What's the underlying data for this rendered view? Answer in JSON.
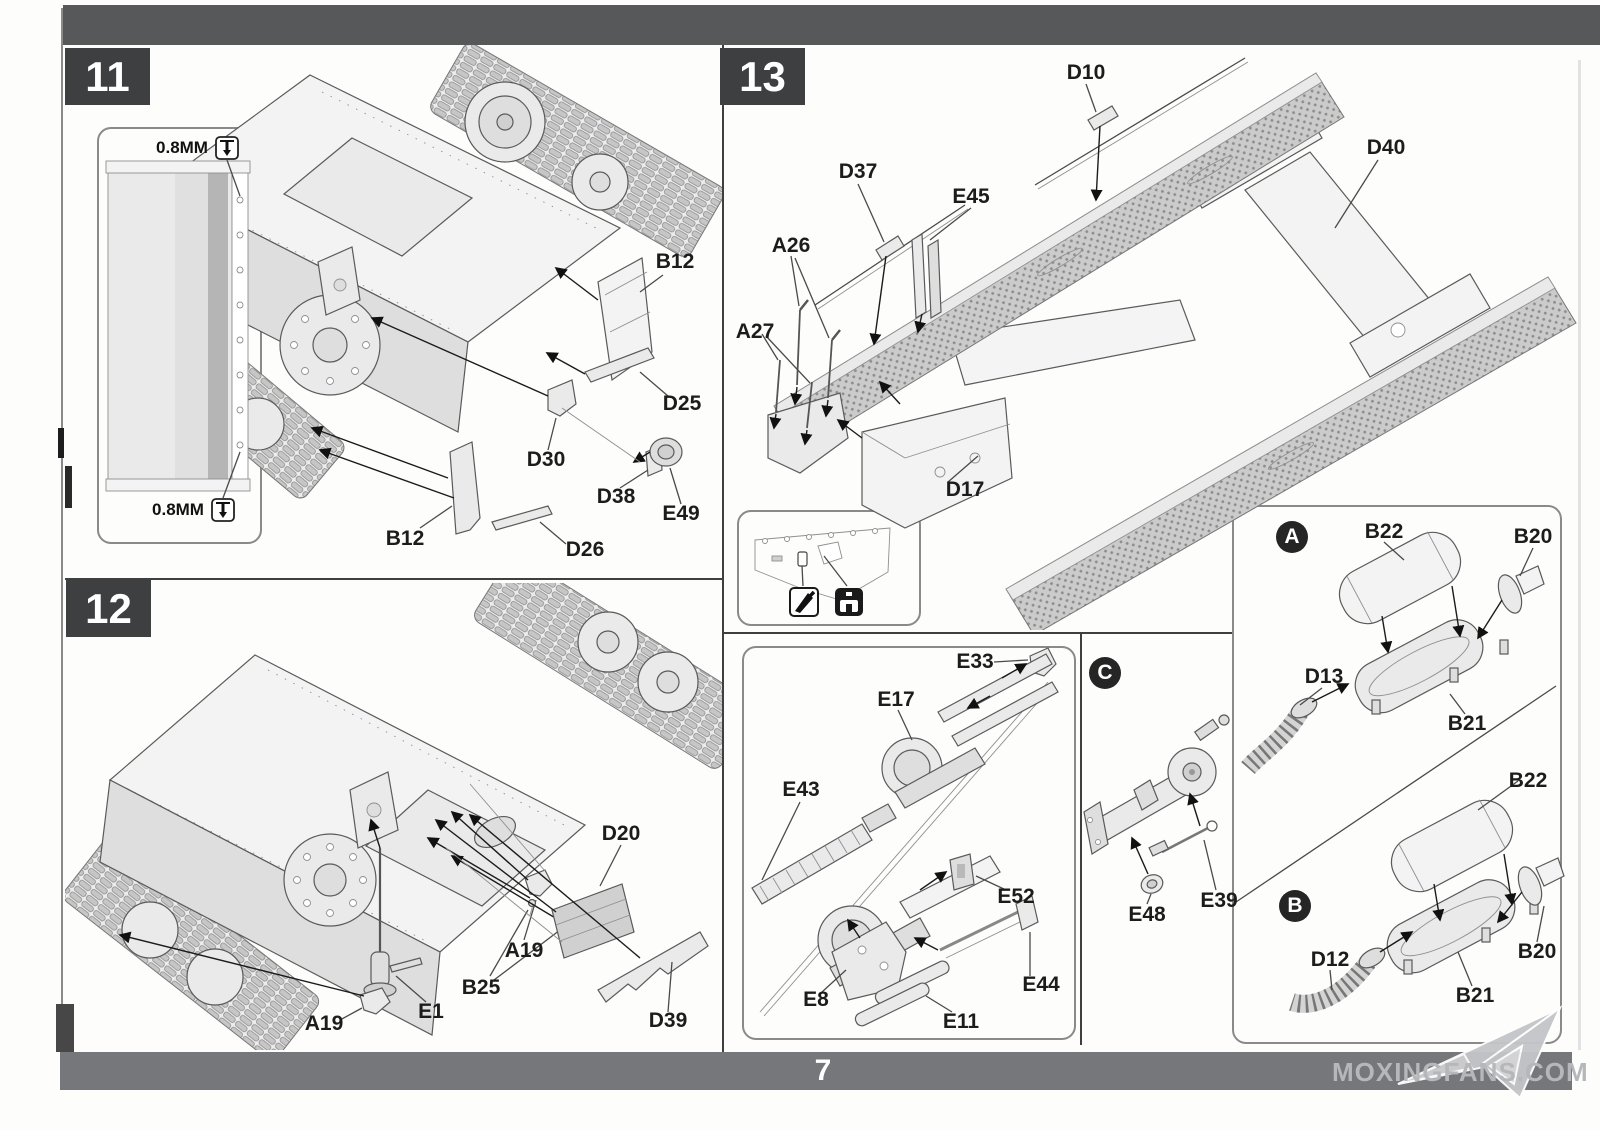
{
  "page": {
    "number": "7",
    "watermark_text": "MOXINGFANS.COM"
  },
  "steps": {
    "s11": {
      "badge": "11",
      "inset": {
        "note_top": "0.8MM",
        "note_bottom": "0.8MM"
      },
      "labels": {
        "b12_top": "B12",
        "d25": "D25",
        "d30": "D30",
        "d38": "D38",
        "e49": "E49",
        "b12_bottom": "B12",
        "d26": "D26"
      }
    },
    "s12": {
      "badge": "12",
      "labels": {
        "d20": "D20",
        "a19_right": "A19",
        "b25": "B25",
        "e1": "E1",
        "a19_left": "A19",
        "d39": "D39"
      }
    },
    "s13": {
      "badge": "13",
      "labels": {
        "d10": "D10",
        "d40": "D40",
        "d37": "D37",
        "e45": "E45",
        "a26": "A26",
        "a27": "A27",
        "d17": "D17"
      }
    },
    "ebox": {
      "labels": {
        "e33": "E33",
        "e17": "E17",
        "e43": "E43",
        "e52": "E52",
        "e8": "E8",
        "e44": "E44",
        "e11": "E11"
      }
    },
    "cbox": {
      "badge": "C",
      "labels": {
        "e48": "E48",
        "e39": "E39"
      }
    },
    "abox": {
      "badge": "A",
      "labels": {
        "b22": "B22",
        "b20": "B20",
        "d13": "D13",
        "b21": "B21"
      }
    },
    "bbox": {
      "badge": "B",
      "labels": {
        "b22": "B22",
        "b20": "B20",
        "d12": "D12",
        "b21": "B21"
      }
    }
  }
}
